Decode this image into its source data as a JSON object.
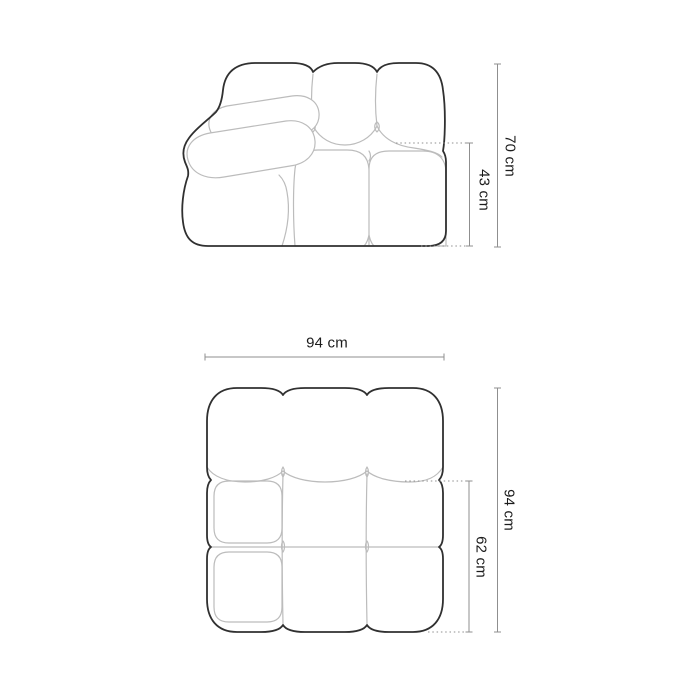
{
  "diagram": {
    "views": {
      "front": {
        "dimensions": {
          "height_total": "70 cm",
          "height_seat": "43 cm"
        }
      },
      "top": {
        "dimensions": {
          "width": "94 cm",
          "depth_total": "94 cm",
          "depth_seat": "62 cm"
        }
      }
    },
    "colors": {
      "outline_dark": "#303030",
      "outline_light": "#bcbcbc",
      "dimension_line": "#8f8f8f",
      "label_text": "#1c1c1c",
      "background": "#ffffff"
    }
  }
}
